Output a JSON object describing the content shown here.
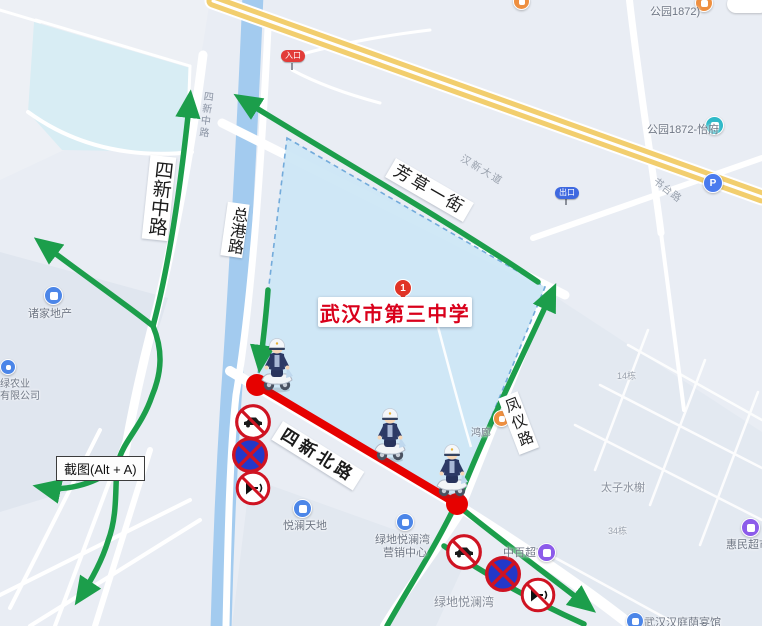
{
  "map": {
    "school": {
      "name": "武汉市第三中学",
      "marker": "1"
    },
    "road_labels": {
      "sixin_middle": "四新中路",
      "sixin_middle_small": "四新中路",
      "zonggang": "总港路",
      "fangcao_yijie": "芳草一街",
      "hanxin_avenue": "汉新大道",
      "sixin_north": "四新北路",
      "fengyi": "凤仪路",
      "shutai": "书台路"
    },
    "badges": {
      "entrance": "入口",
      "exit": "出口",
      "parking": "P"
    },
    "pois": {
      "park1872": "公园1872)",
      "park1872_yifu": "公园1872-怡府",
      "zhujia_realty": "诸家地产",
      "lvnongye_line1": "绿农业",
      "lvnongye_line2": "有限公司",
      "yuelan_tiandi": "悦澜天地",
      "lvdi_marketing_line1": "绿地悦澜湾",
      "lvdi_marketing_line2": "营销中心",
      "zhongbai_market": "中百超市",
      "huimin_market": "惠民超市",
      "taizi_shuixie": "太子水榭",
      "building14": "14栋",
      "building34": "34栋",
      "lvdi_area": "绿地悦澜湾",
      "hotel": "武汉汉庭荫宴馆",
      "honglang": "鸿廊"
    },
    "overlay": {
      "screenshot_hint": "截图(Alt + A)"
    },
    "annotations": {
      "sign_icons": [
        "no-motor-vehicles",
        "no-stopping",
        "no-horn"
      ],
      "police_count": "3",
      "closed_segment_road": "四新北路"
    },
    "colors": {
      "route_green": "#1C9E4B",
      "closed_red": "#E60100",
      "school_fill": "#CDE7F5",
      "water": "#A3CBEF",
      "highway_yellow": "#F2CE6E",
      "school_text": "#D9001B"
    }
  }
}
